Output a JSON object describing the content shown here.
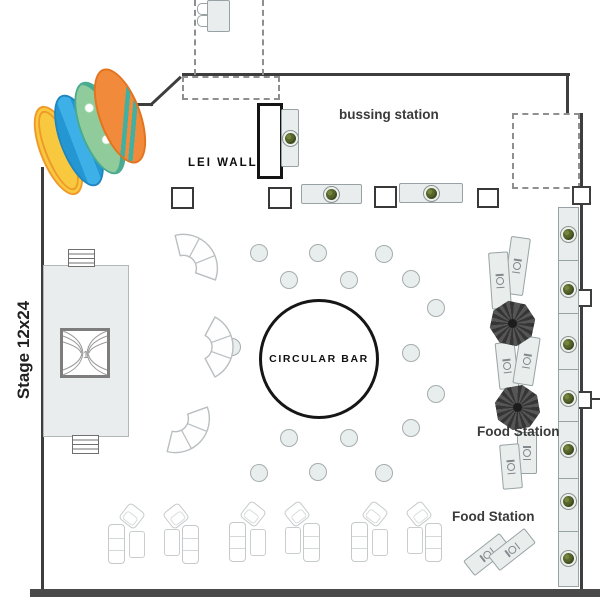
{
  "labels": {
    "bussing_station": "bussing station",
    "lei_wall": "LEI WALL",
    "circular_bar": "CIRCULAR BAR",
    "stage": "Stage 12x24",
    "food_station_upper": "Food Station",
    "food_station_lower": "Food Station"
  },
  "colors": {
    "wall": "#3e3e3e",
    "bottom_wall": "#4a4a4a",
    "furniture_fill": "#e9edee",
    "furniture_border": "#98a2a4",
    "wreath_green": "#55642a",
    "umbrella_dark": "#3a3a3a",
    "surfboard_yellow": "#f8c93e",
    "surfboard_blue": "#2ea3dc",
    "surfboard_green": "#8fcb9b",
    "surfboard_orange": "#f18a3a"
  },
  "plan": {
    "walls": [
      {
        "x": 132,
        "y": 103,
        "w": 21,
        "h": 2.5
      },
      {
        "x": 182,
        "y": 73,
        "w": 388,
        "h": 3
      },
      {
        "x": 566,
        "y": 73,
        "w": 3,
        "h": 42
      },
      {
        "x": 580,
        "y": 113,
        "w": 2.5,
        "h": 480
      },
      {
        "x": 41,
        "y": 167,
        "w": 2.5,
        "h": 426
      },
      {
        "x": 588,
        "y": 398,
        "w": 12,
        "h": 2
      },
      {
        "x": 30,
        "y": 589,
        "w": 570,
        "h": 8,
        "t": 1
      }
    ],
    "diagonals": [
      {
        "x": 150,
        "y": 104,
        "len": 42,
        "rot": -43
      }
    ],
    "dashed_lines": [
      {
        "x": 194,
        "y": 0,
        "h": 75
      },
      {
        "x": 262,
        "y": 0,
        "h": 75
      }
    ],
    "dashed_rects": [
      {
        "x": 182,
        "y": 76,
        "w": 94,
        "h": 20
      },
      {
        "x": 512,
        "y": 113,
        "w": 64,
        "h": 72
      }
    ],
    "door_squares": [
      {
        "x": 572,
        "y": 186,
        "w": 15,
        "h": 15
      },
      {
        "x": 574,
        "y": 289,
        "w": 14,
        "h": 14
      },
      {
        "x": 574,
        "y": 391,
        "w": 14,
        "h": 14
      }
    ],
    "square_tables": [
      {
        "x": 171,
        "y": 187,
        "w": 19,
        "h": 18
      },
      {
        "x": 268,
        "y": 187,
        "w": 20,
        "h": 18
      },
      {
        "x": 374,
        "y": 186,
        "w": 19,
        "h": 18
      },
      {
        "x": 477,
        "y": 188,
        "w": 18,
        "h": 16
      }
    ],
    "buffet_tables": [
      {
        "x": 301,
        "y": 184,
        "w": 59,
        "h": 18
      },
      {
        "x": 399,
        "y": 183,
        "w": 62,
        "h": 18
      },
      {
        "x": 281,
        "y": 109,
        "w": 16,
        "h": 56
      }
    ],
    "buffet_strip": {
      "x": 558,
      "y": 207,
      "w": 19,
      "h": 378,
      "dividers": [
        52,
        105,
        161,
        213,
        270,
        323
      ],
      "wreaths": [
        26,
        81,
        136,
        190,
        241,
        293,
        350
      ]
    },
    "registration": {
      "table": {
        "x": 207,
        "y": 0,
        "w": 21,
        "h": 30
      },
      "chairs": [
        {
          "x": 197,
          "y": 3
        },
        {
          "x": 197,
          "y": 15
        }
      ]
    },
    "stage_steps": [
      {
        "x": 68,
        "y": 249,
        "w": 25,
        "h": 16
      },
      {
        "x": 72,
        "y": 435,
        "w": 25,
        "h": 17
      }
    ],
    "bar": {
      "cx": 316,
      "cy": 356,
      "r": 57
    },
    "cocktail_tables": [
      [
        258,
        252
      ],
      [
        317,
        252
      ],
      [
        383,
        253
      ],
      [
        288,
        279
      ],
      [
        348,
        279
      ],
      [
        410,
        278
      ],
      [
        435,
        307
      ],
      [
        231,
        346
      ],
      [
        410,
        352
      ],
      [
        435,
        393
      ],
      [
        410,
        427
      ],
      [
        288,
        437
      ],
      [
        348,
        437
      ],
      [
        258,
        472
      ],
      [
        317,
        471
      ],
      [
        383,
        472
      ]
    ],
    "serpentine_sofas": [
      {
        "x": 159,
        "y": 217,
        "rot": -42
      },
      {
        "x": 179,
        "y": 307,
        "rot": 0
      },
      {
        "x": 151,
        "y": 390,
        "rot": 42
      }
    ],
    "umbrellas": [
      {
        "x": 491,
        "y": 302,
        "s": 43,
        "rot": 12
      },
      {
        "x": 496,
        "y": 386,
        "s": 43,
        "rot": -10
      }
    ],
    "food_tables": [
      {
        "x": 507,
        "y": 237,
        "w": 18,
        "h": 56,
        "rot": 8,
        "ir": 90
      },
      {
        "x": 490,
        "y": 252,
        "w": 18,
        "h": 55,
        "rot": -4,
        "ir": 90
      },
      {
        "x": 497,
        "y": 342,
        "w": 18,
        "h": 45,
        "rot": -6,
        "ir": 90
      },
      {
        "x": 516,
        "y": 336,
        "w": 19,
        "h": 47,
        "rot": 9,
        "ir": 90
      },
      {
        "x": 517,
        "y": 432,
        "w": 18,
        "h": 40,
        "rot": 0,
        "ir": 90
      },
      {
        "x": 501,
        "y": 444,
        "w": 18,
        "h": 43,
        "rot": -5,
        "ir": 90
      },
      {
        "x": 464,
        "y": 545,
        "w": 44,
        "h": 17,
        "rot": -38,
        "ir": 0
      },
      {
        "x": 489,
        "y": 540,
        "w": 44,
        "h": 17,
        "rot": -38,
        "ir": 0
      }
    ],
    "lounge_groups": {
      "origins": [
        [
          107,
          505
        ],
        [
          228,
          503
        ],
        [
          350,
          503
        ]
      ],
      "items": [
        {
          "t": "s",
          "x": 1,
          "y": 19,
          "w": 15,
          "h": 38
        },
        {
          "t": "c",
          "x": 15,
          "y": 1,
          "w": 18,
          "h": 18,
          "rot": 38
        },
        {
          "t": "t",
          "x": 22,
          "y": 26,
          "w": 14,
          "h": 25
        },
        {
          "t": "t",
          "x": 57,
          "y": 24,
          "w": 14,
          "h": 25
        },
        {
          "t": "c",
          "x": 59,
          "y": 1,
          "w": 18,
          "h": 18,
          "rot": -38
        },
        {
          "t": "s",
          "x": 75,
          "y": 20,
          "w": 15,
          "h": 37
        }
      ]
    },
    "surfboards": [
      {
        "cls": "sb-yellow",
        "name": "surfboard-yellow",
        "x": 40,
        "y": 103,
        "w": 33,
        "h": 91,
        "rot": -22
      },
      {
        "cls": "sb-blue",
        "name": "surfboard-blue",
        "x": 60,
        "y": 92,
        "w": 34,
        "h": 93,
        "rot": -21
      },
      {
        "cls": "sb-green",
        "name": "surfboard-green",
        "x": 80,
        "y": 79,
        "w": 36,
        "h": 94,
        "rot": -21
      },
      {
        "cls": "sb-orange",
        "name": "surfboard-orange",
        "x": 99,
        "y": 66,
        "w": 38,
        "h": 96,
        "rot": -20
      }
    ]
  }
}
